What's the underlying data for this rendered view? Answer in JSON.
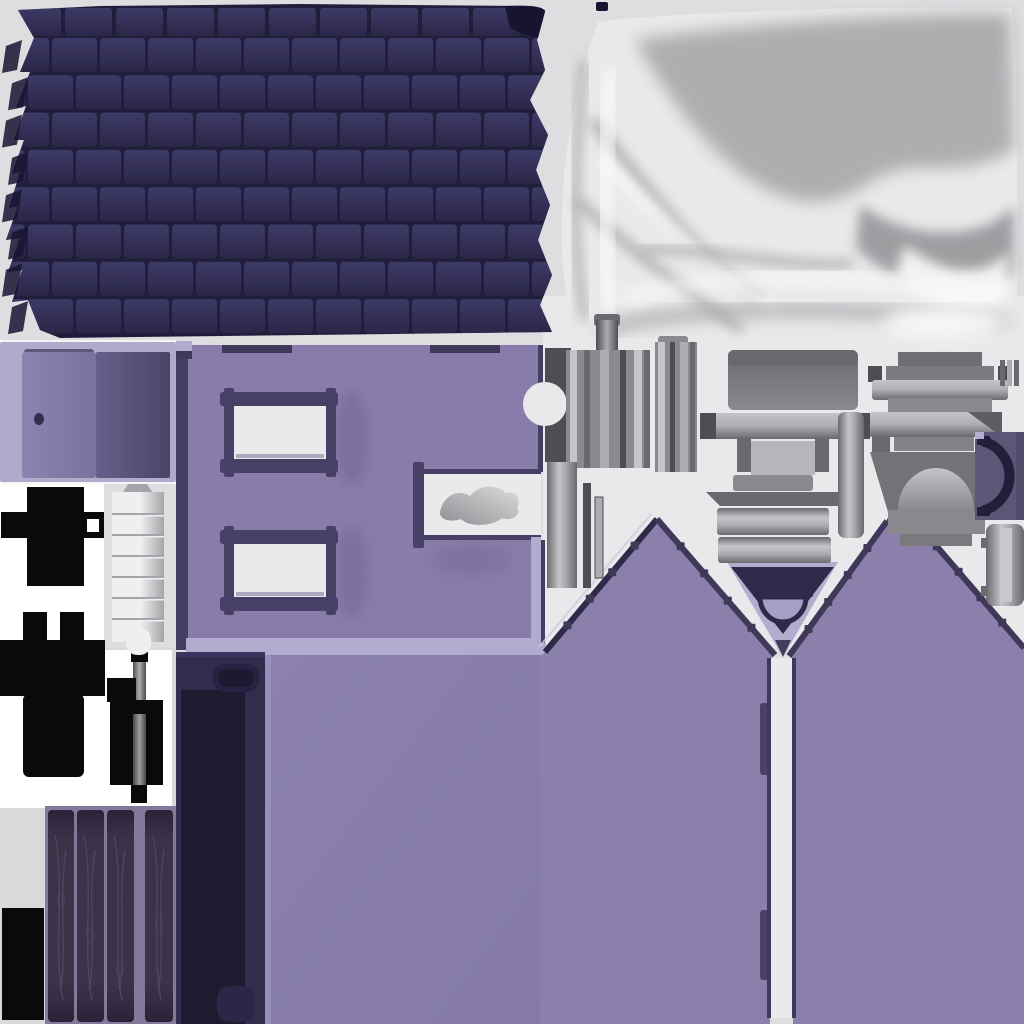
{
  "atlas": {
    "canvas": {
      "width": 1024,
      "height": 1024
    },
    "regions": [
      {
        "name": "roof-shingle-texture"
      },
      {
        "name": "satin-cloth-texture"
      },
      {
        "name": "door-panel-island"
      },
      {
        "name": "wall-with-windows-island"
      },
      {
        "name": "window-frame-upper"
      },
      {
        "name": "window-frame-lower"
      },
      {
        "name": "chimney-smoke-notch"
      },
      {
        "name": "black-cutout-cross"
      },
      {
        "name": "black-cutout-tee"
      },
      {
        "name": "hinge-cutout"
      },
      {
        "name": "bellows-stack"
      },
      {
        "name": "dark-beam-island"
      },
      {
        "name": "floor-panel-island"
      },
      {
        "name": "plank-door-island"
      },
      {
        "name": "black-cutout-square"
      },
      {
        "name": "left-gable-wall"
      },
      {
        "name": "right-gable-wall"
      },
      {
        "name": "gable-vent-inset"
      },
      {
        "name": "door-slot-gap"
      },
      {
        "name": "metal-flange-cylinder-a"
      },
      {
        "name": "metal-flange-cylinder-b"
      },
      {
        "name": "metal-center-stack"
      },
      {
        "name": "metal-strip-set"
      },
      {
        "name": "chimney-cap-piece"
      },
      {
        "name": "collar-piece"
      },
      {
        "name": "fireplace-arch-piece"
      },
      {
        "name": "arc-handle-piece"
      },
      {
        "name": "metal-sleeve-piece"
      }
    ]
  },
  "colors": {
    "bg": "#dedde0",
    "bg_panel": "#e9e9eb",
    "bg_low": "#d9d8db",
    "white": "#ffffff",
    "roof_base": "#211e3c",
    "roof_tile_hi": "#3d3a67",
    "roof_tile": "#343058",
    "roof_tile_lo": "#2a2748",
    "roof_edge_dark": "#171431",
    "fabric_base": "#e9e9eb",
    "fabric_shade": "#ababae",
    "fabric_deep": "#919195",
    "fabric_hi": "#fafafb",
    "door_bg": "#b2aacb",
    "door_leaf": "#7b719d",
    "door_leaf_hi": "#8c83b0",
    "door_dark_hi": "#675f8a",
    "door_leaf_dark": "#4b4368",
    "door_knob": "#332c4e",
    "wall": "#887daa",
    "wall_light": "#b3abcf",
    "wall_edge": "#453e63",
    "wall_shadow": "#6f6592",
    "frame_dark": "#473f66",
    "pane": "#eae9ec",
    "smoke_dark": "#8f8f93",
    "smoke_light": "#dcdcde",
    "black": "#0a0a0a",
    "metal_hi": "#c6c4c8",
    "metal_light": "#aeacb1",
    "metal_mid": "#8b888e",
    "metal_dark": "#6b686e",
    "metal_deep": "#4f4d52",
    "stack_light": "#efeff1",
    "stack_dark": "#a5a4a8",
    "navy": "#312d4d",
    "navy_dark": "#1e1b31",
    "navy_mid": "#262243",
    "gable": "#8b80ac",
    "gable_dark": "#3f3859",
    "gable_light": "#b4add0",
    "vent_dark": "#2e2a49",
    "vent_fill": "#a79fc6",
    "slate": "#5d5677",
    "arc_dark": "#231f3a",
    "wood_back": "#85799b",
    "plank": "#3c3349",
    "plank_edge": "#2a2338",
    "grain": "#584d6b",
    "floor": "#8c81ad",
    "floor_dark": "#857aa6",
    "slot_white": "#eae9eb"
  }
}
